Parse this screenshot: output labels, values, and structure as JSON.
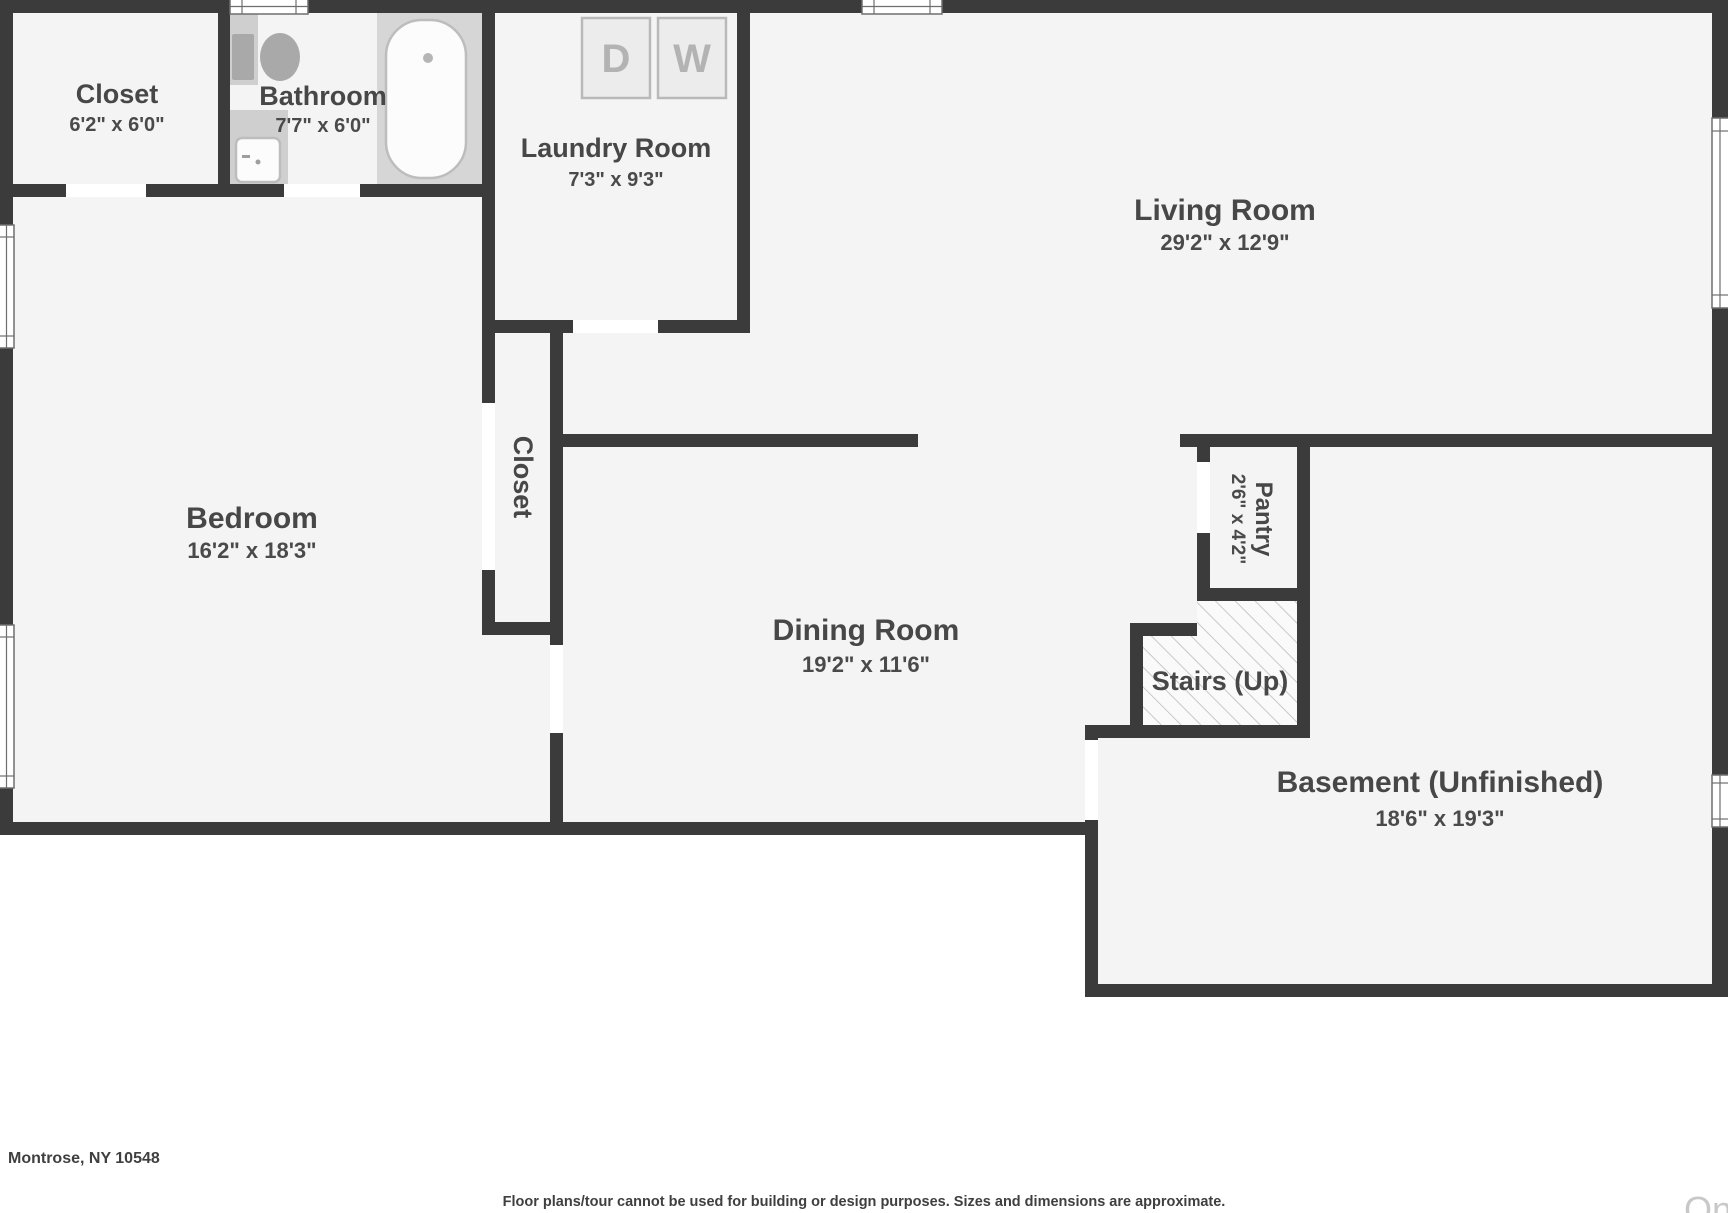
{
  "floorplan": {
    "rooms": {
      "closet_tl": {
        "name": "Closet",
        "dims": "6'2\" x 6'0\""
      },
      "bathroom": {
        "name": "Bathroom",
        "dims": "7'7\" x 6'0\""
      },
      "laundry": {
        "name": "Laundry Room",
        "dims": "7'3\" x 9'3\""
      },
      "living": {
        "name": "Living Room",
        "dims": "29'2\" x 12'9\""
      },
      "bedroom": {
        "name": "Bedroom",
        "dims": "16'2\" x 18'3\""
      },
      "closet_mid": {
        "name": "Closet"
      },
      "dining": {
        "name": "Dining Room",
        "dims": "19'2\" x 11'6\""
      },
      "pantry": {
        "name": "Pantry",
        "dims": "2'6\" x 4'2\""
      },
      "stairs": {
        "name": "Stairs (Up)"
      },
      "basement": {
        "name": "Basement (Unfinished)",
        "dims": "18'6\" x 19'3\""
      }
    },
    "appliances": {
      "dryer": "D",
      "washer": "W"
    },
    "colors": {
      "wall": "#3b3b3b",
      "floor": "#f4f4f4",
      "label_text": "#474747",
      "fixture_gray": "#a9a9a9",
      "appliance_letter": "#b3b3b3",
      "hatch_line": "#c8c8c8",
      "watermark": "#c8c8c8",
      "background": "#ffffff"
    }
  },
  "footer": {
    "address": "Montrose, NY 10548",
    "disclaimer": "Floor plans/tour cannot be used for building or design purposes. Sizes and dimensions are approximate.",
    "watermark": "On"
  }
}
